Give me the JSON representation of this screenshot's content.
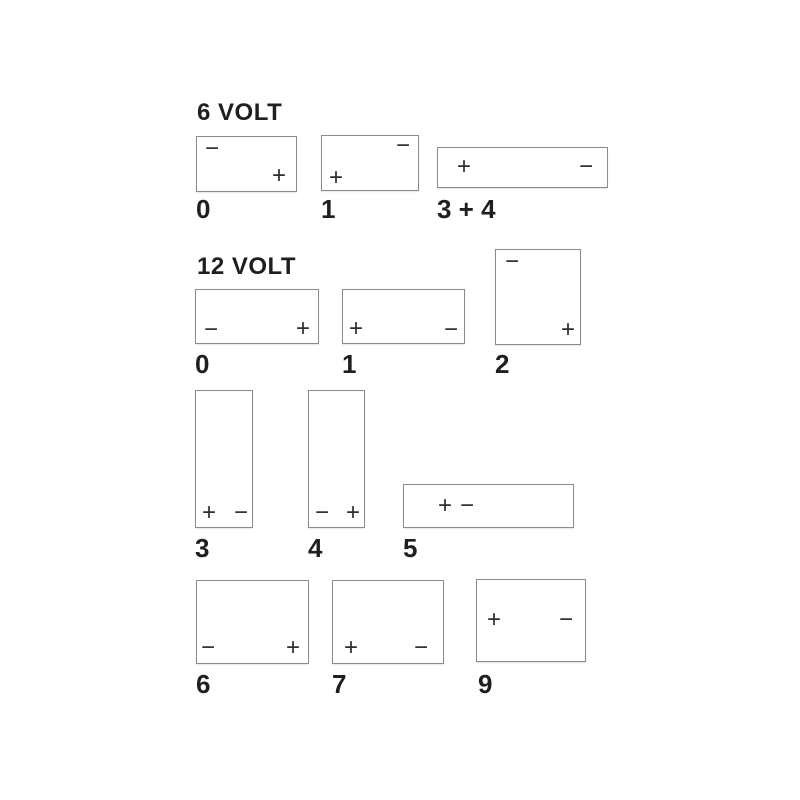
{
  "diagram": {
    "title": "Battery terminal layout diagram",
    "background_color": "#ffffff",
    "box_border_color": "#8a8a8a",
    "text_color": "#1f1f1f",
    "terminal_color": "#2e2e2e",
    "sections": [
      {
        "id": "6-volt",
        "heading": "6 VOLT",
        "heading_pos": {
          "x": 197,
          "y": 101
        },
        "batteries": [
          {
            "code": "0",
            "box": {
              "x": 196,
              "y": 136,
              "w": 99,
              "h": 54
            },
            "label_pos": {
              "x": 196,
              "y": 196
            },
            "terminals": [
              {
                "symbol": "−",
                "name": "minus",
                "position": "top-left",
                "x": 15,
                "y": 12
              },
              {
                "symbol": "+",
                "name": "plus",
                "position": "bottom-right",
                "x": 82,
                "y": 39
              }
            ]
          },
          {
            "code": "1",
            "box": {
              "x": 321,
              "y": 135,
              "w": 96,
              "h": 54
            },
            "label_pos": {
              "x": 321,
              "y": 196
            },
            "terminals": [
              {
                "symbol": "−",
                "name": "minus",
                "position": "top-right",
                "x": 81,
                "y": 10
              },
              {
                "symbol": "+",
                "name": "plus",
                "position": "bottom-left",
                "x": 14,
                "y": 42
              }
            ]
          },
          {
            "code": "3 + 4",
            "box": {
              "x": 437,
              "y": 147,
              "w": 169,
              "h": 39
            },
            "label_pos": {
              "x": 437,
              "y": 196
            },
            "terminals": [
              {
                "symbol": "+",
                "name": "plus",
                "position": "middle-left",
                "x": 26,
                "y": 19
              },
              {
                "symbol": "−",
                "name": "minus",
                "position": "middle-right",
                "x": 148,
                "y": 19
              }
            ]
          }
        ]
      },
      {
        "id": "12-volt",
        "heading": "12 VOLT",
        "heading_pos": {
          "x": 197,
          "y": 255
        },
        "batteries": [
          {
            "code": "0",
            "box": {
              "x": 195,
              "y": 289,
              "w": 122,
              "h": 53
            },
            "label_pos": {
              "x": 195,
              "y": 351
            },
            "terminals": [
              {
                "symbol": "−",
                "name": "minus",
                "position": "bottom-left",
                "x": 15,
                "y": 40
              },
              {
                "symbol": "+",
                "name": "plus",
                "position": "bottom-right",
                "x": 107,
                "y": 39
              }
            ]
          },
          {
            "code": "1",
            "box": {
              "x": 342,
              "y": 289,
              "w": 121,
              "h": 53
            },
            "label_pos": {
              "x": 342,
              "y": 351
            },
            "terminals": [
              {
                "symbol": "+",
                "name": "plus",
                "position": "bottom-left",
                "x": 13,
                "y": 39
              },
              {
                "symbol": "−",
                "name": "minus",
                "position": "bottom-right",
                "x": 108,
                "y": 40
              }
            ]
          },
          {
            "code": "2",
            "box": {
              "x": 495,
              "y": 249,
              "w": 84,
              "h": 94
            },
            "label_pos": {
              "x": 495,
              "y": 351
            },
            "terminals": [
              {
                "symbol": "−",
                "name": "minus",
                "position": "top-left",
                "x": 16,
                "y": 12
              },
              {
                "symbol": "+",
                "name": "plus",
                "position": "bottom-right",
                "x": 72,
                "y": 80
              }
            ]
          },
          {
            "code": "3",
            "box": {
              "x": 195,
              "y": 390,
              "w": 56,
              "h": 136
            },
            "label_pos": {
              "x": 195,
              "y": 535
            },
            "terminals": [
              {
                "symbol": "+",
                "name": "plus",
                "position": "bottom-left",
                "x": 13,
                "y": 122
              },
              {
                "symbol": "−",
                "name": "minus",
                "position": "bottom-right",
                "x": 45,
                "y": 122
              }
            ]
          },
          {
            "code": "4",
            "box": {
              "x": 308,
              "y": 390,
              "w": 55,
              "h": 136
            },
            "label_pos": {
              "x": 308,
              "y": 535
            },
            "terminals": [
              {
                "symbol": "−",
                "name": "minus",
                "position": "bottom-left",
                "x": 13,
                "y": 122
              },
              {
                "symbol": "+",
                "name": "plus",
                "position": "bottom-right",
                "x": 44,
                "y": 122
              }
            ]
          },
          {
            "code": "5",
            "box": {
              "x": 403,
              "y": 484,
              "w": 169,
              "h": 42
            },
            "label_pos": {
              "x": 403,
              "y": 535
            },
            "terminals": [
              {
                "symbol": "+",
                "name": "plus",
                "position": "center-left",
                "x": 41,
                "y": 21
              },
              {
                "symbol": "−",
                "name": "minus",
                "position": "center-left",
                "x": 63,
                "y": 21
              }
            ]
          },
          {
            "code": "6",
            "box": {
              "x": 196,
              "y": 580,
              "w": 111,
              "h": 82
            },
            "label_pos": {
              "x": 196,
              "y": 671
            },
            "terminals": [
              {
                "symbol": "−",
                "name": "minus",
                "position": "bottom-left",
                "x": 11,
                "y": 67
              },
              {
                "symbol": "+",
                "name": "plus",
                "position": "bottom-right",
                "x": 96,
                "y": 67
              }
            ]
          },
          {
            "code": "7",
            "box": {
              "x": 332,
              "y": 580,
              "w": 110,
              "h": 82
            },
            "label_pos": {
              "x": 332,
              "y": 671
            },
            "terminals": [
              {
                "symbol": "+",
                "name": "plus",
                "position": "bottom-left",
                "x": 18,
                "y": 67
              },
              {
                "symbol": "−",
                "name": "minus",
                "position": "bottom-right",
                "x": 88,
                "y": 67
              }
            ]
          },
          {
            "code": "9",
            "box": {
              "x": 476,
              "y": 579,
              "w": 108,
              "h": 81
            },
            "label_pos": {
              "x": 478,
              "y": 671
            },
            "terminals": [
              {
                "symbol": "+",
                "name": "plus",
                "position": "middle-left",
                "x": 17,
                "y": 40
              },
              {
                "symbol": "−",
                "name": "minus",
                "position": "middle-right",
                "x": 89,
                "y": 40
              }
            ]
          }
        ]
      }
    ]
  }
}
